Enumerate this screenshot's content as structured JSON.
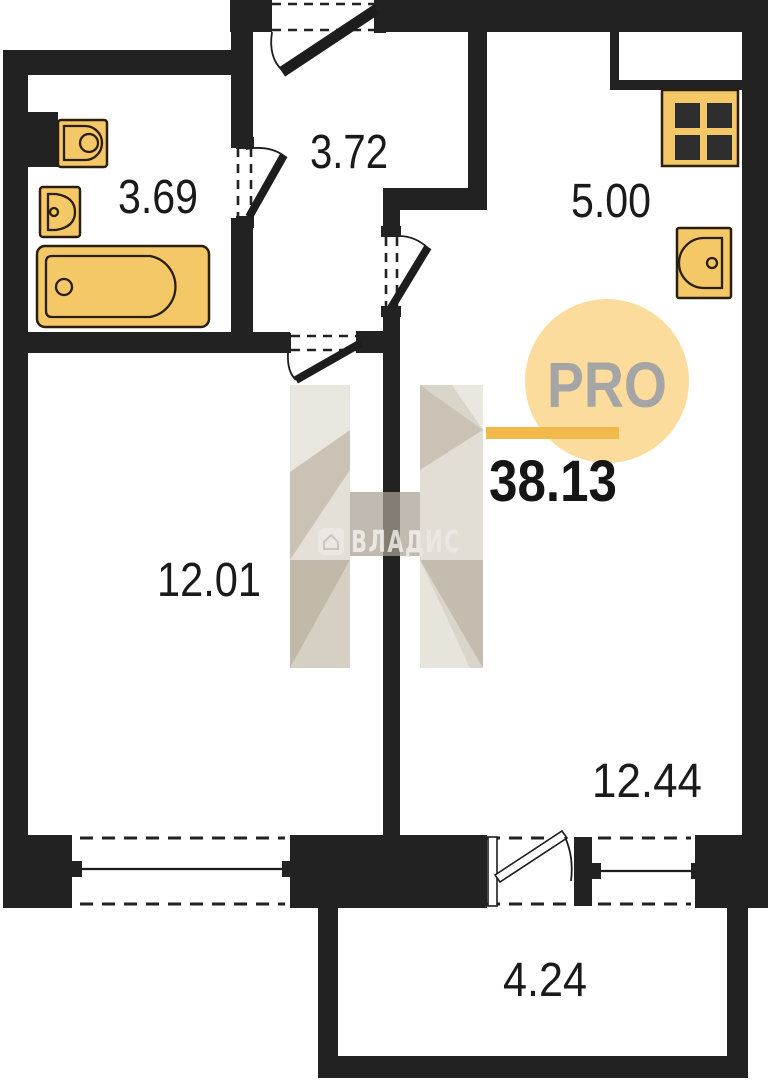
{
  "plan": {
    "type": "apartment-floor-plan",
    "rooms": [
      {
        "id": "bathroom",
        "area": "3.69"
      },
      {
        "id": "hallway",
        "area": "3.72"
      },
      {
        "id": "kitchen",
        "area": "5.00"
      },
      {
        "id": "room",
        "area": "12.01"
      },
      {
        "id": "living-room",
        "area": "12.44"
      },
      {
        "id": "balcony",
        "area": "4.24"
      }
    ],
    "total_area": "38.13"
  },
  "logo": {
    "label": "PRO"
  },
  "watermark": {
    "brand": "ВЛАДИС"
  },
  "colors": {
    "wall": "#222222",
    "fixture_yellow": "#F4C767",
    "fixture_outline": "#2a1e0c",
    "logo_circle": "#FBDC9C",
    "logo_bar": "#F2B94B",
    "logo_text_gray": "#A5A5A5",
    "watermark_beige": "#D6D0C6",
    "background": "#ffffff"
  }
}
